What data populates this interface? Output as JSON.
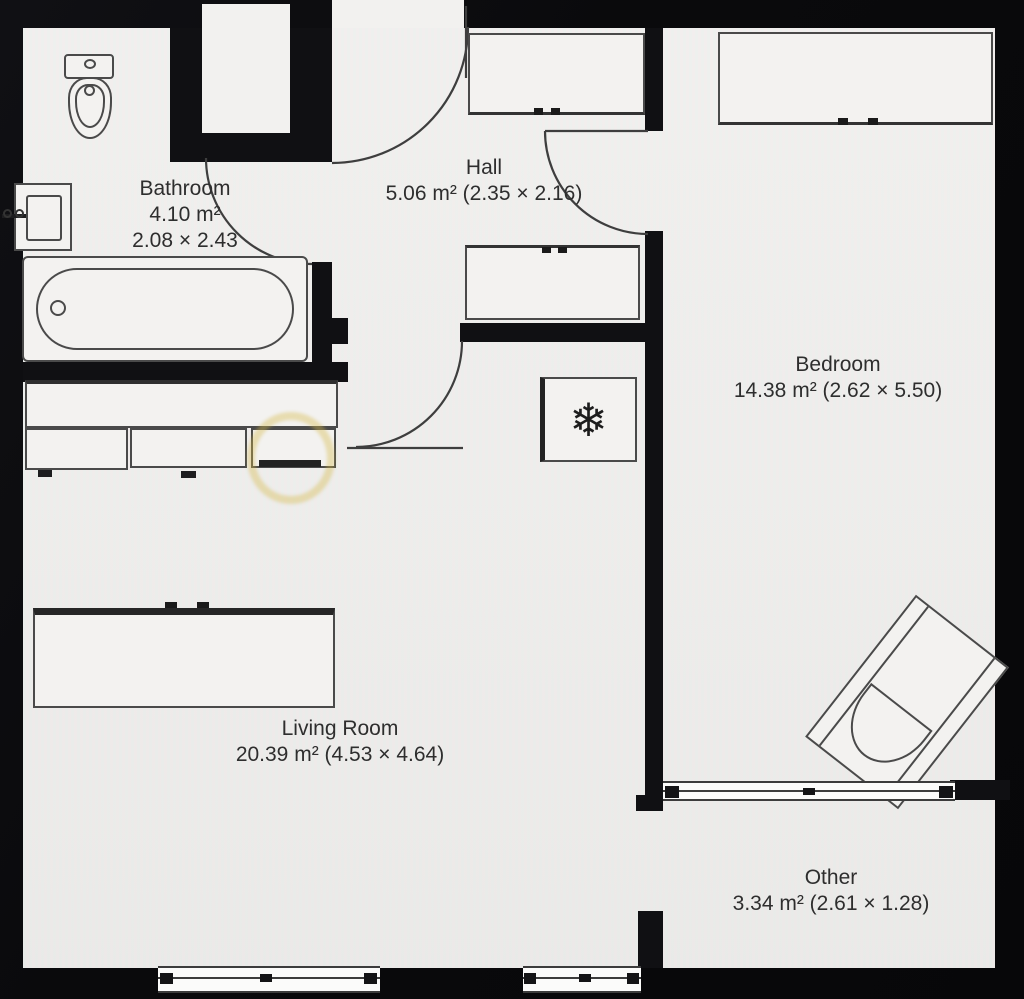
{
  "plan": {
    "rooms": {
      "bathroom": {
        "name": "Bathroom",
        "area": "4.10 m²",
        "dims": "2.08 × 2.43"
      },
      "hall": {
        "name": "Hall",
        "detail": "5.06 m² (2.35 × 2.16)"
      },
      "bedroom": {
        "name": "Bedroom",
        "detail": "14.38 m² (2.62 × 5.50)"
      },
      "living_room": {
        "name": "Living Room",
        "detail": "20.39 m² (4.53 × 4.64)"
      },
      "other": {
        "name": "Other",
        "detail": "3.34 m² (2.61 × 1.28)"
      }
    },
    "icons": {
      "snowflake": "❄"
    },
    "colors": {
      "wall": "#101013",
      "floor": "#f0efed",
      "line": "#3e3e3e",
      "highlight": "#d6b846"
    }
  }
}
